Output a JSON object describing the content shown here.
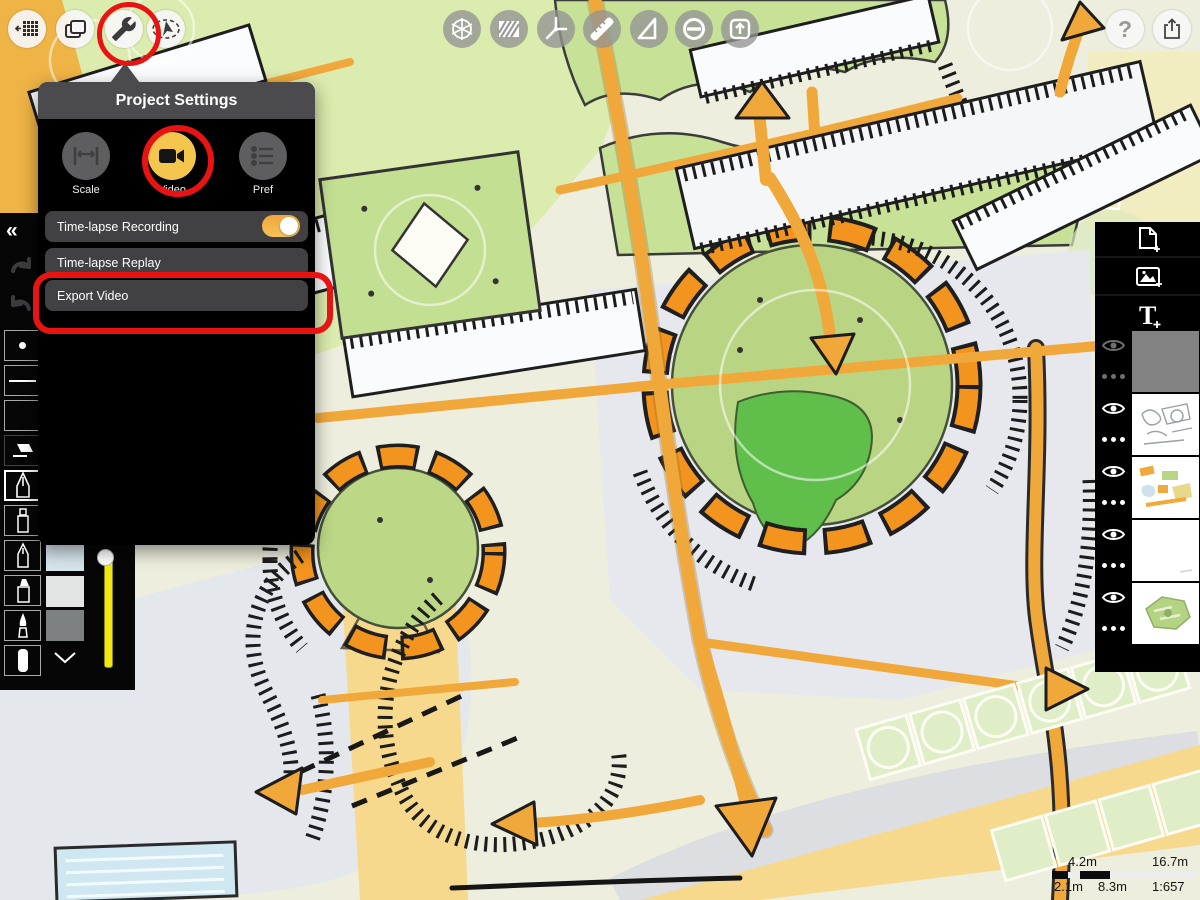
{
  "colors": {
    "annotation_red": "#e81414",
    "accent_yellow": "#f4c64d",
    "toggle_orange": "#f2a93d",
    "road_orange": "#f1a83a",
    "ring_orange": "#f2941d",
    "slider_yellow": "#f0e812"
  },
  "top_left_toolbar": {
    "buttons": [
      {
        "name": "canvas-grid-button",
        "icon": "grid-arrow-icon"
      },
      {
        "name": "projects-button",
        "icon": "stacked-pages-icon"
      },
      {
        "name": "project-settings-button",
        "icon": "wrench-icon",
        "annotated": true
      },
      {
        "name": "orient-button",
        "icon": "compass-cursor-icon"
      }
    ]
  },
  "top_center_toolbar": {
    "buttons": [
      {
        "name": "view-3d-button",
        "icon": "sphere-axes-icon"
      },
      {
        "name": "hatch-fill-button",
        "icon": "hatch-square-icon"
      },
      {
        "name": "angle-tool-button",
        "icon": "angle-icon"
      },
      {
        "name": "ruler-tool-button",
        "icon": "ruler-icon"
      },
      {
        "name": "set-square-button",
        "icon": "triangle-icon"
      },
      {
        "name": "restrict-button",
        "icon": "circle-minus-icon"
      },
      {
        "name": "stamp-export-button",
        "icon": "box-up-arrow-icon"
      }
    ]
  },
  "top_right_toolbar": {
    "help_glyph": "?",
    "buttons": [
      {
        "name": "help-button",
        "icon": "question-icon"
      },
      {
        "name": "share-button",
        "icon": "share-tray-icon"
      }
    ]
  },
  "popover": {
    "title": "Project Settings",
    "tabs": [
      {
        "label": "Scale",
        "icon": "measure-icon",
        "active": false
      },
      {
        "label": "Video",
        "icon": "video-camera-icon",
        "active": true,
        "annotated": true
      },
      {
        "label": "Pref",
        "icon": "list-icon",
        "active": false
      }
    ],
    "rows": [
      {
        "label": "Time-lapse Recording",
        "control": "toggle",
        "state": "on"
      },
      {
        "label": "Time-lapse Replay",
        "control": "button"
      },
      {
        "label": "Export Video",
        "control": "button",
        "annotated": true
      }
    ]
  },
  "left_toolbar": {
    "collapse_glyph": "«",
    "buttons": [
      "undo-button",
      "redo-button"
    ],
    "tools": [
      "dot-tool",
      "line-tool",
      "blank-tool",
      "eraser-tool",
      "technical-pen-tool",
      "fineliner-tool",
      "pen-tool",
      "marker-tool",
      "brush-tool",
      "soft-pencil-tool"
    ],
    "selected_tool": "technical-pen-tool",
    "color_swatches": [
      "#d6e4ec",
      "#e3e5e4",
      "#7e8182"
    ],
    "more_colors_icon": "chevron-down-icon",
    "size_slider": {
      "knob_position": "top"
    }
  },
  "layers_panel": {
    "add_buttons": [
      {
        "name": "add-page-button",
        "icon": "page-plus-icon"
      },
      {
        "name": "add-image-button",
        "icon": "image-plus-icon"
      },
      {
        "name": "add-text-button",
        "icon": "text-plus-icon",
        "glyph": "T"
      }
    ],
    "layers": [
      {
        "visible": true,
        "selected": true,
        "thumb": "solid-gray"
      },
      {
        "visible": true,
        "selected": false,
        "thumb": "line-sketch"
      },
      {
        "visible": true,
        "selected": false,
        "thumb": "color-sketch"
      },
      {
        "visible": true,
        "selected": false,
        "thumb": "blank"
      },
      {
        "visible": true,
        "selected": false,
        "thumb": "green-map"
      }
    ]
  },
  "scale_bar": {
    "upper_left": "4.2m",
    "upper_right": "16.7m",
    "lower_left": "2.1m",
    "lower_mid": "8.3m",
    "ratio": "1:657"
  }
}
